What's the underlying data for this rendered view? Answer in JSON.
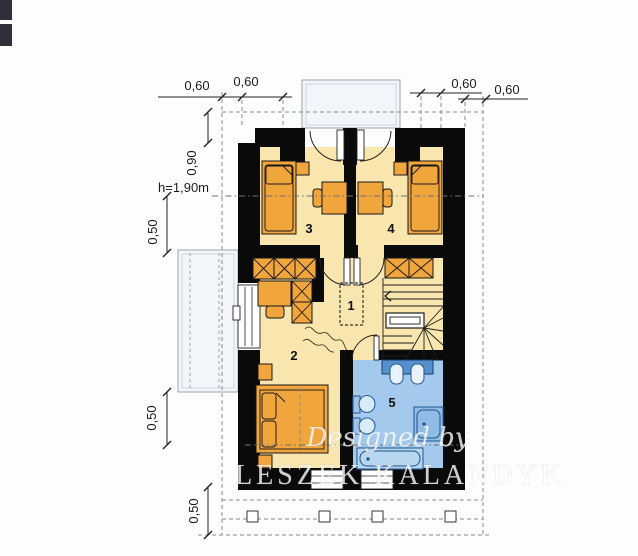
{
  "plan": {
    "type": "architectural-floor-plan-attic-storey",
    "dims": {
      "tl1": "0,60",
      "tl2": "0,60",
      "tr1": "0,60",
      "tr2": "0,60",
      "v090": "0,90",
      "h190": "h=1,90m",
      "v050a": "0,50",
      "v050b": "0,50",
      "v050c": "0,50"
    },
    "rooms": {
      "r1": "1",
      "r2": "2",
      "r3": "3",
      "r4": "4",
      "r5": "5"
    },
    "watermark": {
      "line1": "Designed by",
      "line2": "LESZEK KALANDYK"
    },
    "colors": {
      "wall": "#0a0a0a",
      "floor_cream": "#f9e6ae",
      "floor_bath": "#a3c9ec",
      "furniture_orange": "#f1a53d",
      "fixture_blue_dark": "#5590cc",
      "fixture_fill": "#d9eaf8",
      "balcony_fill": "#f2f6fa",
      "dashed_gray": "#8a8a8a"
    }
  }
}
